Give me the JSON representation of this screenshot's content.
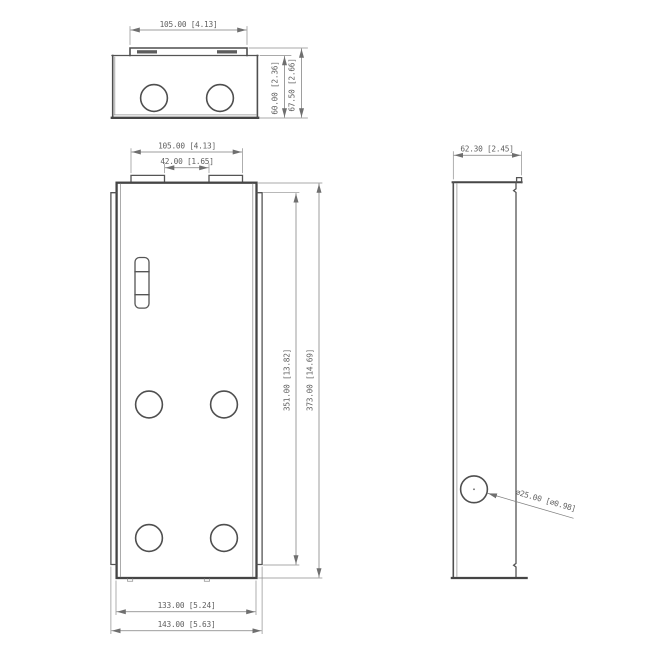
{
  "colors": {
    "background": "#ffffff",
    "outline": "#4a4a4a",
    "dimension_lines": "#8d8d8d",
    "text": "#5f5f5f"
  },
  "views": {
    "top": {
      "dim_width": "105.00 [4.13]",
      "dim_inner_height": "60.00 [2.36]",
      "dim_outer_height": "67.50 [2.66]"
    },
    "front": {
      "dim_tab_span": "105.00 [4.13]",
      "dim_tab_gap": "42.00 [1.65]",
      "dim_inner_height": "351.00 [13.82]",
      "dim_outer_height": "373.00 [14.69]",
      "dim_inner_width": "133.00 [5.24]",
      "dim_outer_width": "143.00 [5.63]"
    },
    "side": {
      "dim_depth": "62.30 [2.45]",
      "dim_hole_diameter": "∅25.00 [∅0.98]"
    }
  }
}
